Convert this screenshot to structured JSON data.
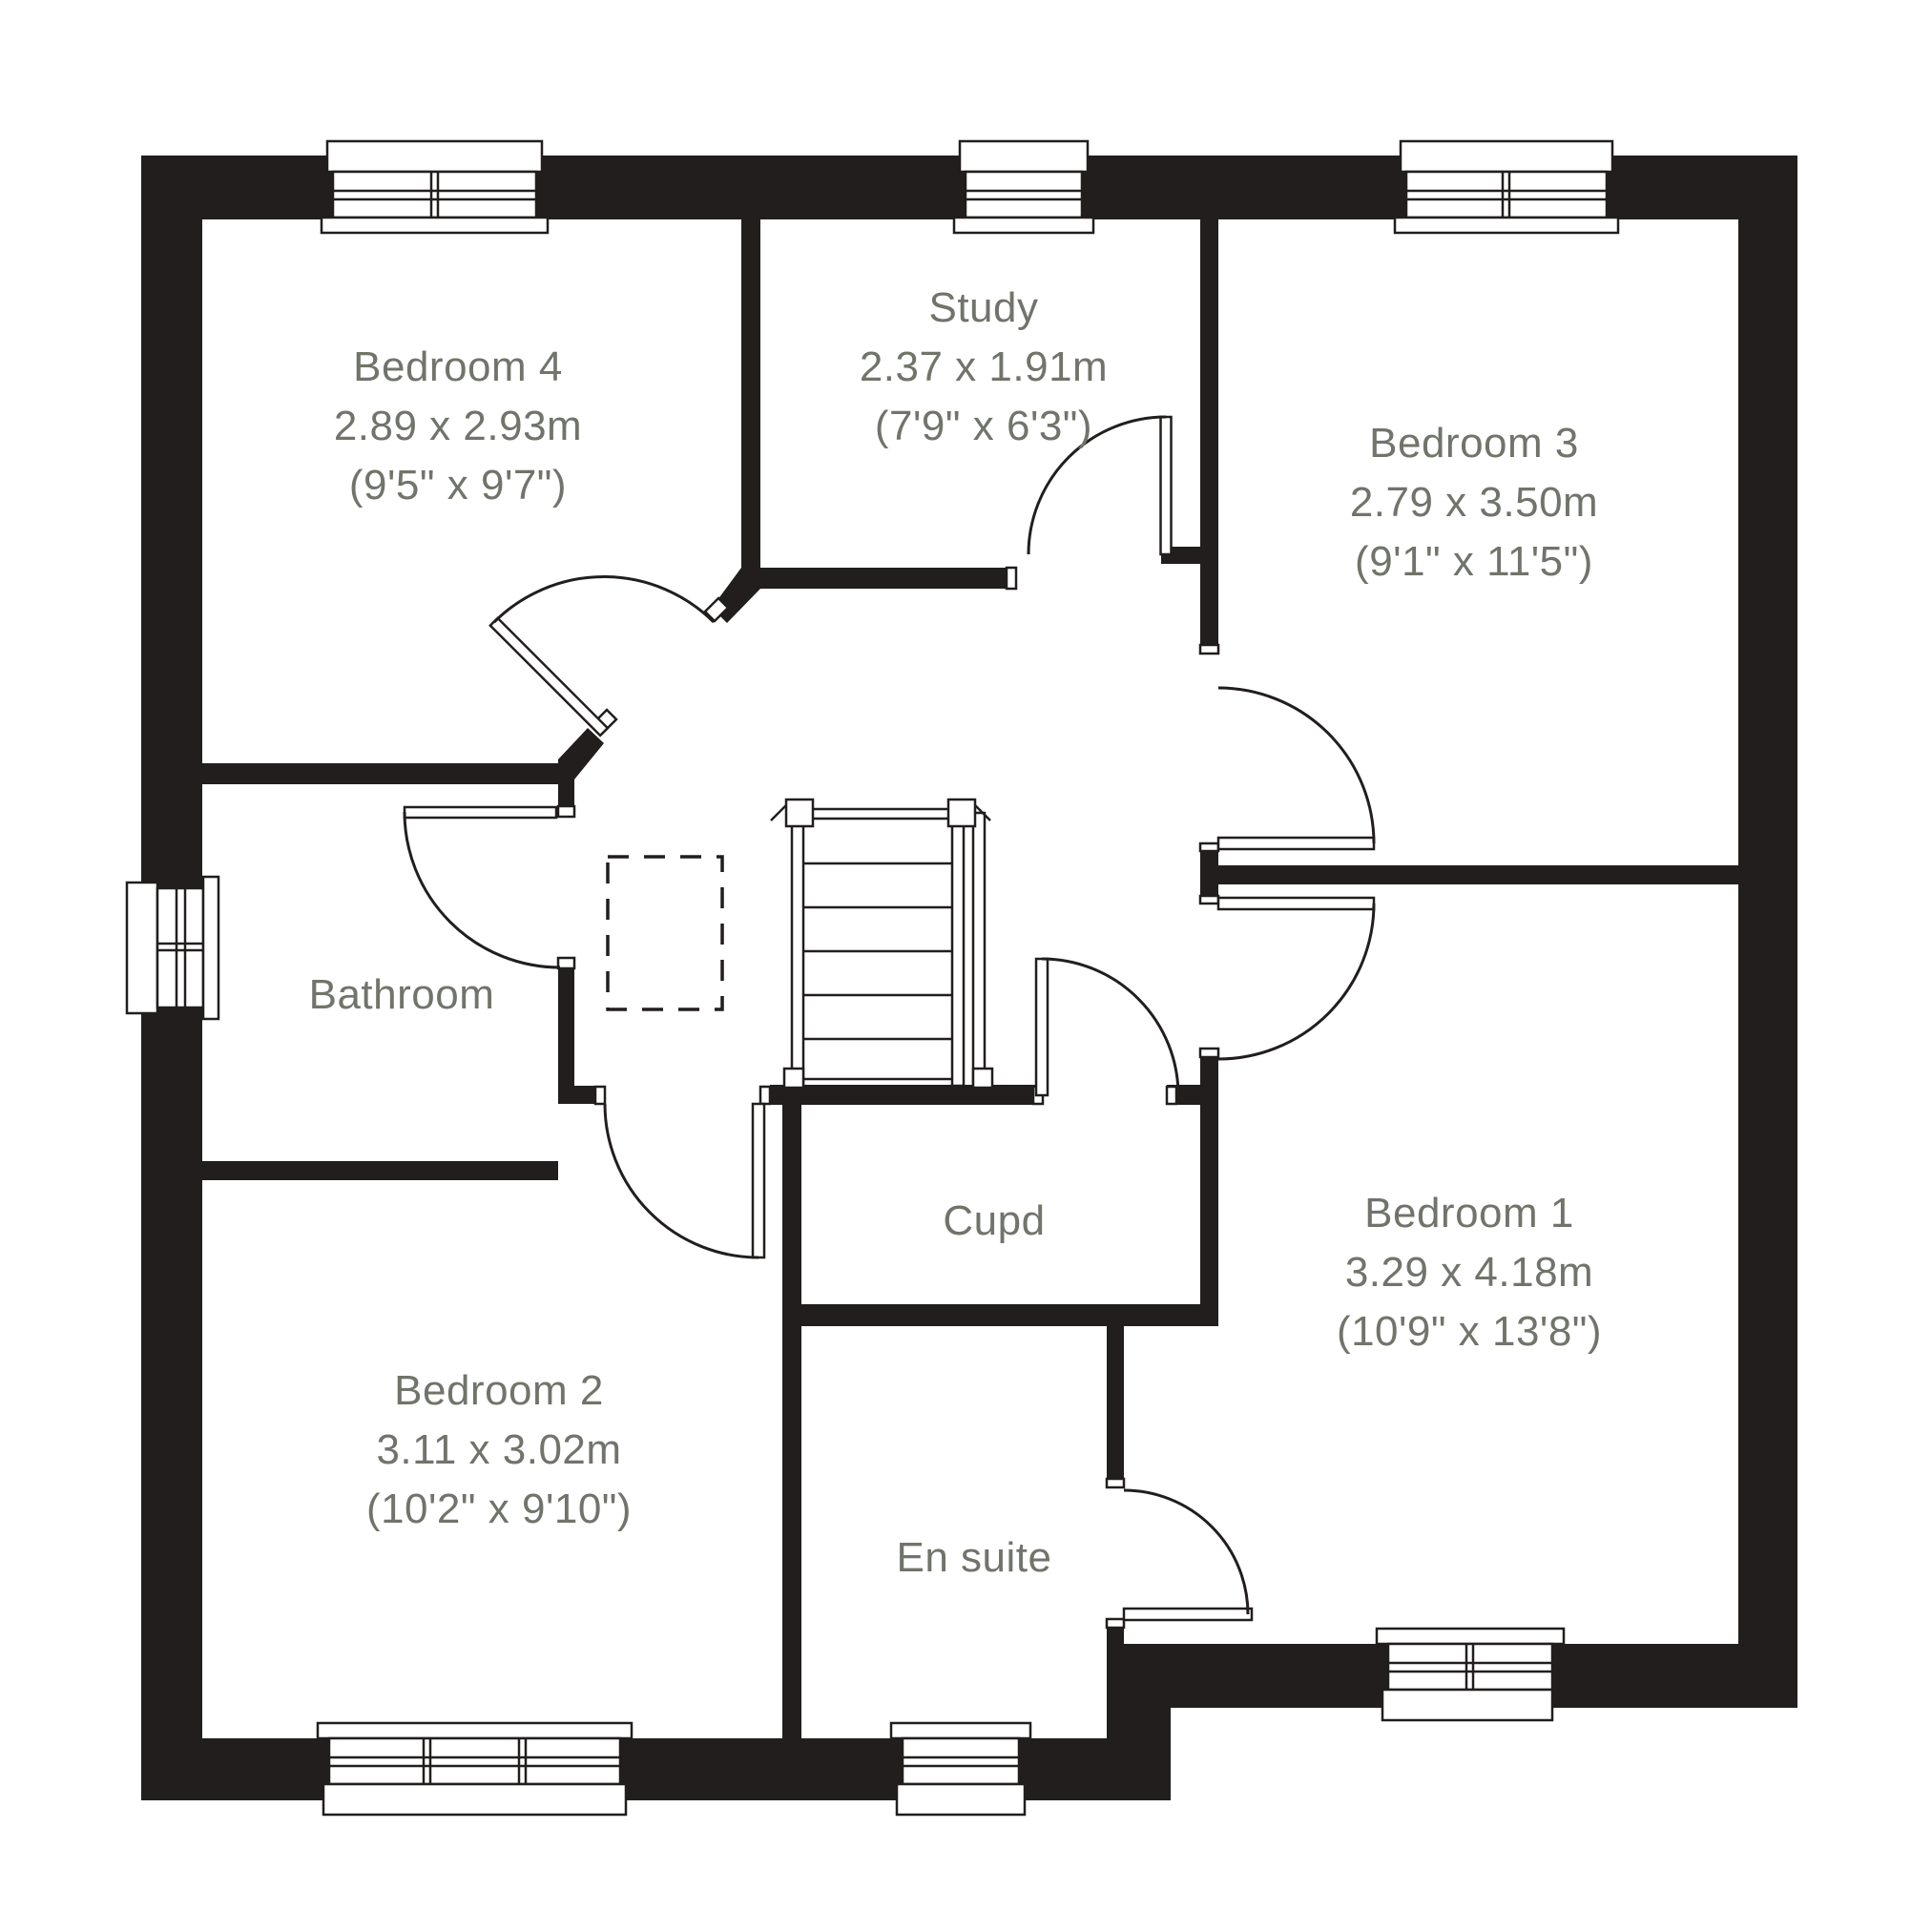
{
  "colors": {
    "wall": "#211e1d",
    "label_text": "#70746a",
    "background": "#ffffff"
  },
  "rooms": {
    "bedroom4": {
      "name": "Bedroom 4",
      "size_metric": "2.89 x 2.93m",
      "size_imperial": "(9'5\" x 9'7\")"
    },
    "study": {
      "name": "Study",
      "size_metric": "2.37 x 1.91m",
      "size_imperial": "(7'9\" x 6'3\")"
    },
    "bedroom3": {
      "name": "Bedroom 3",
      "size_metric": "2.79 x 3.50m",
      "size_imperial": "(9'1\" x 11'5\")"
    },
    "bathroom": {
      "name": "Bathroom"
    },
    "cupboard": {
      "name": "Cupd"
    },
    "bedroom1": {
      "name": "Bedroom 1",
      "size_metric": "3.29 x 4.18m",
      "size_imperial": "(10'9\" x 13'8\")"
    },
    "bedroom2": {
      "name": "Bedroom 2",
      "size_metric": "3.11 x 3.02m",
      "size_imperial": "(10'2\" x 9'10\")"
    },
    "ensuite": {
      "name": "En suite"
    }
  }
}
